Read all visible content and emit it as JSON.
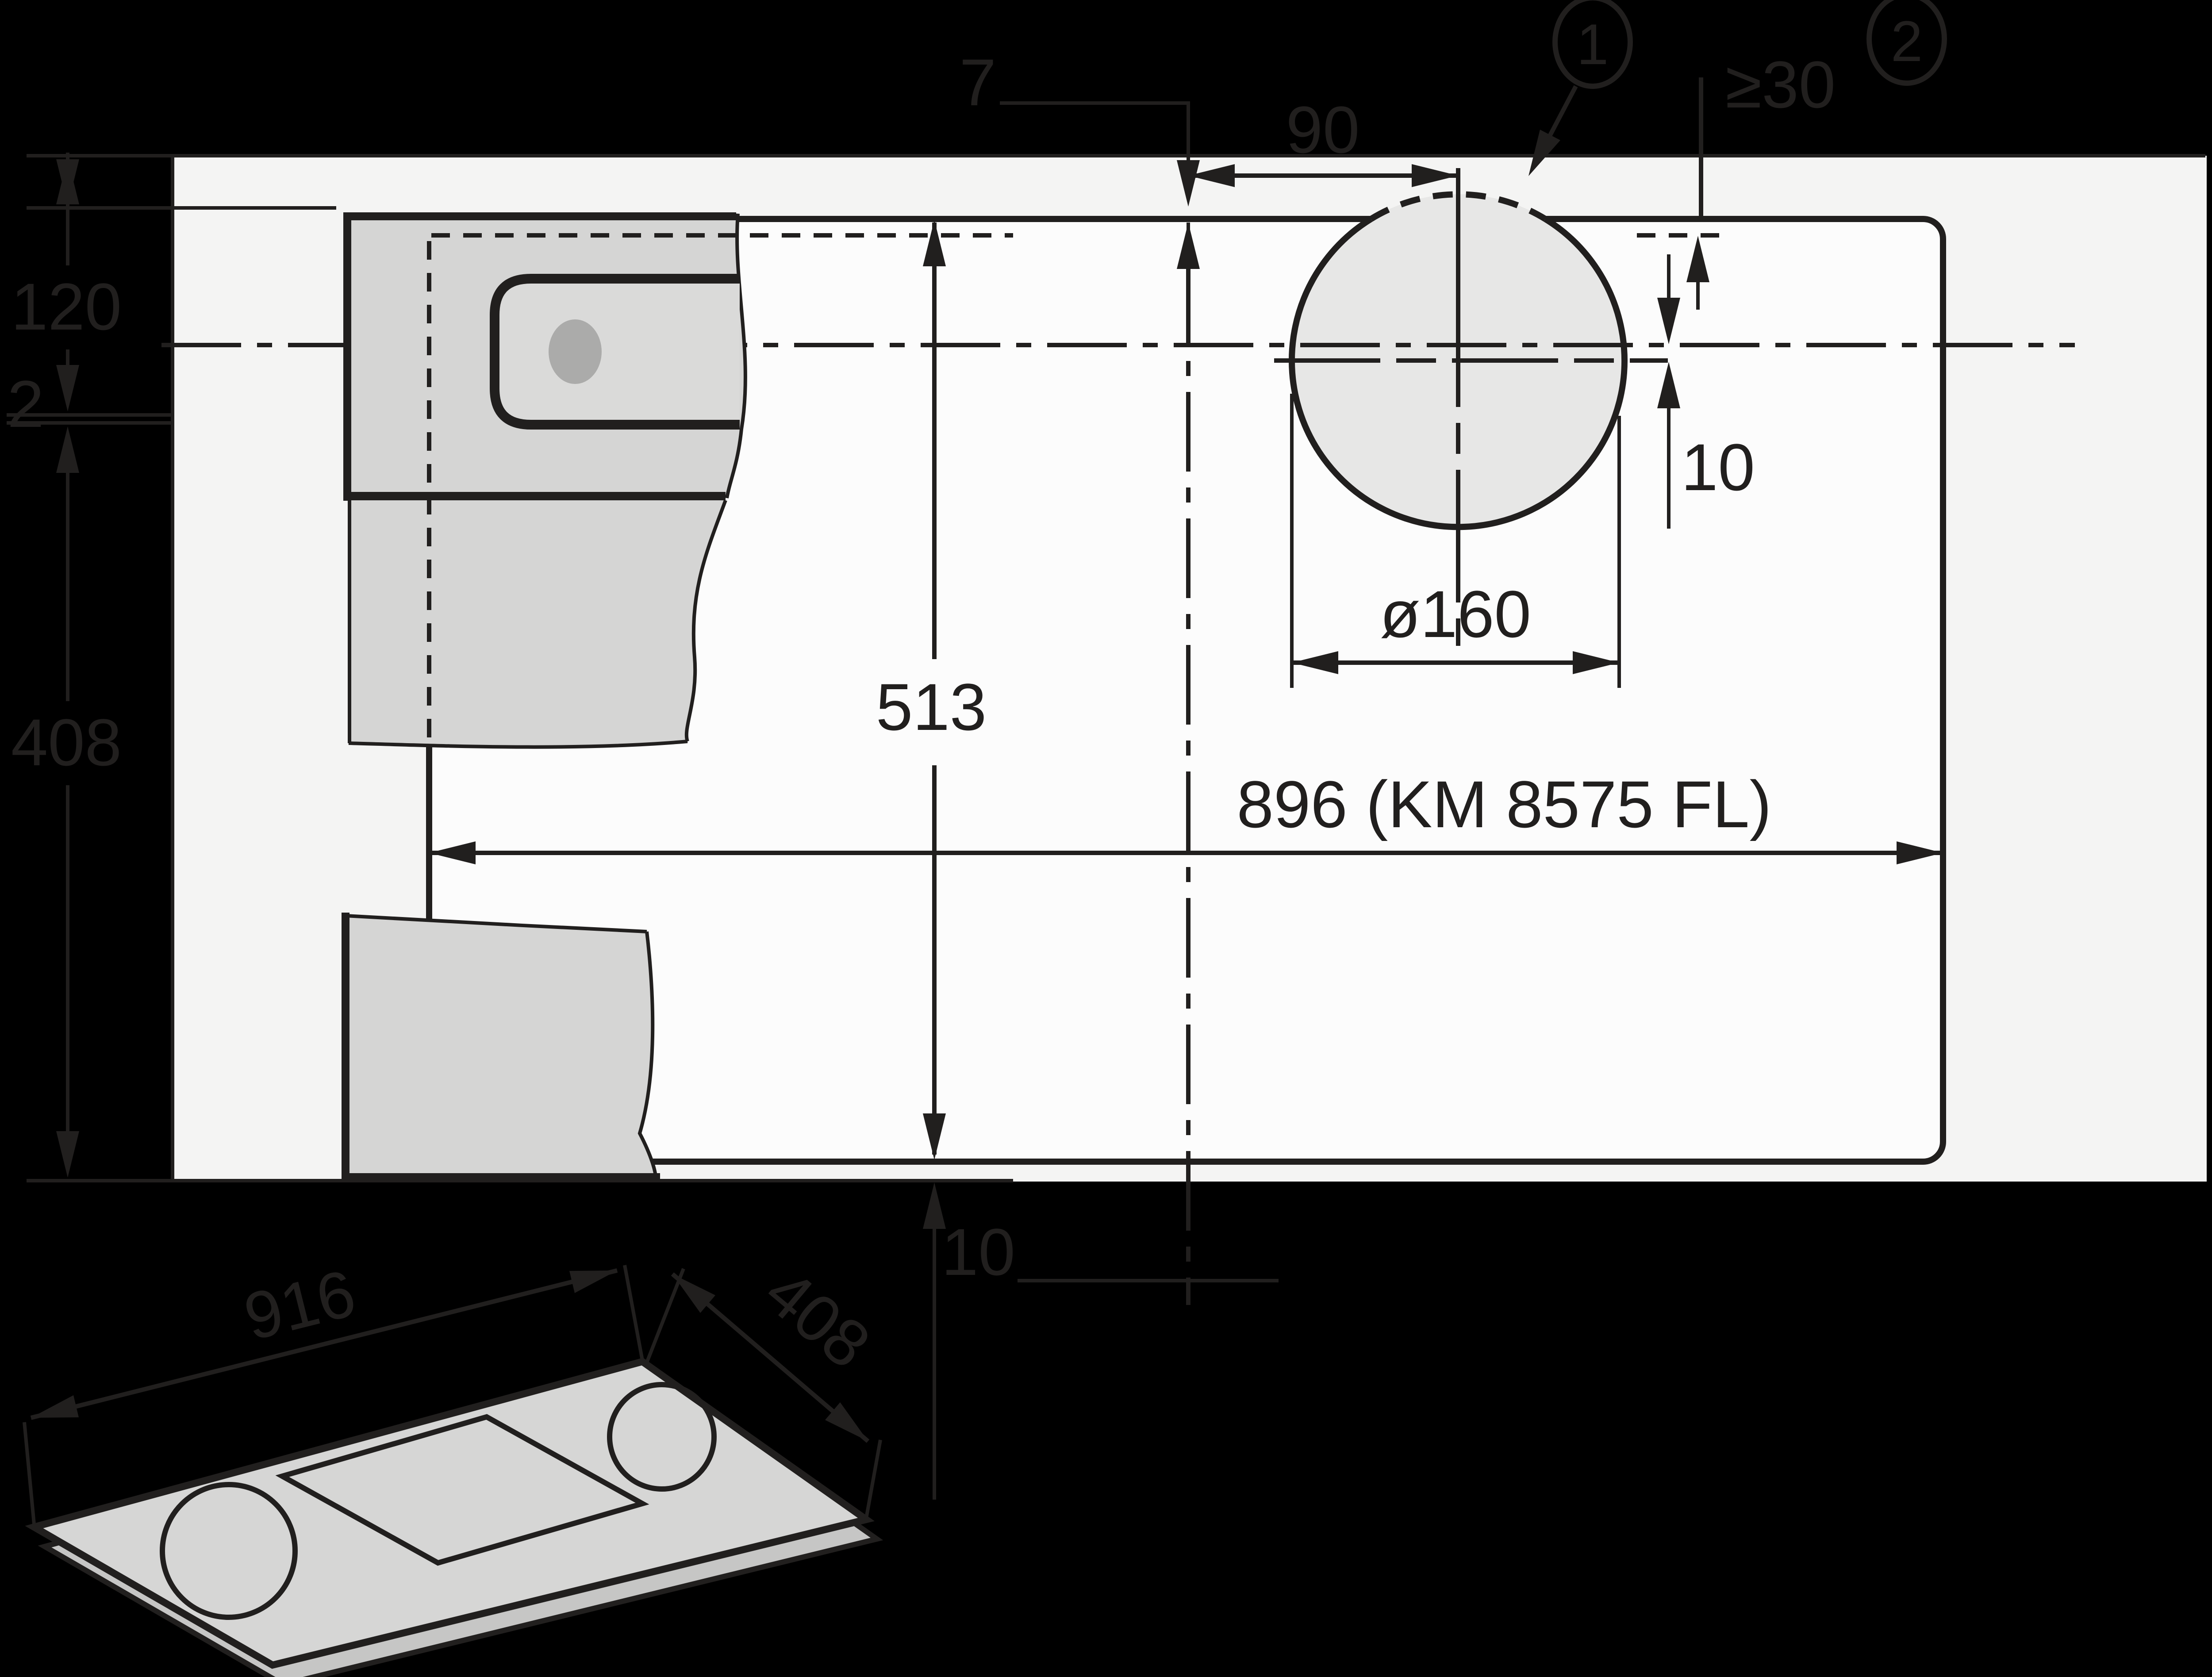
{
  "diagram": {
    "kind": "cooktop-installation-cutout-drawing",
    "product_model": "KM 8575 FL",
    "colors": {
      "line": "#211f1e",
      "worktop": "#f4f4f3",
      "cutout": "#fcfcfc",
      "hole": "#e7e7e6",
      "cabinet": "#d5d5d4",
      "slot": "#dadad9",
      "knob": "#ababaa",
      "isotop": "#d6d6d5",
      "isoside": "#c6c6c5"
    },
    "plan": {
      "top_offset": "7",
      "hole_center_offset": "90",
      "rear_clearance": "≥30",
      "cutout_depth": "513",
      "cutout_width": "896 (KM 8575 FL)",
      "hole_diameter": "ø160",
      "hole_offset": "10",
      "front_gap": "10",
      "left_rear": "120",
      "left_gap": "2",
      "left_front": "408"
    },
    "footnotes": {
      "one": "1",
      "two": "2"
    },
    "iso": {
      "width_label": "916",
      "depth_label": "408"
    }
  }
}
